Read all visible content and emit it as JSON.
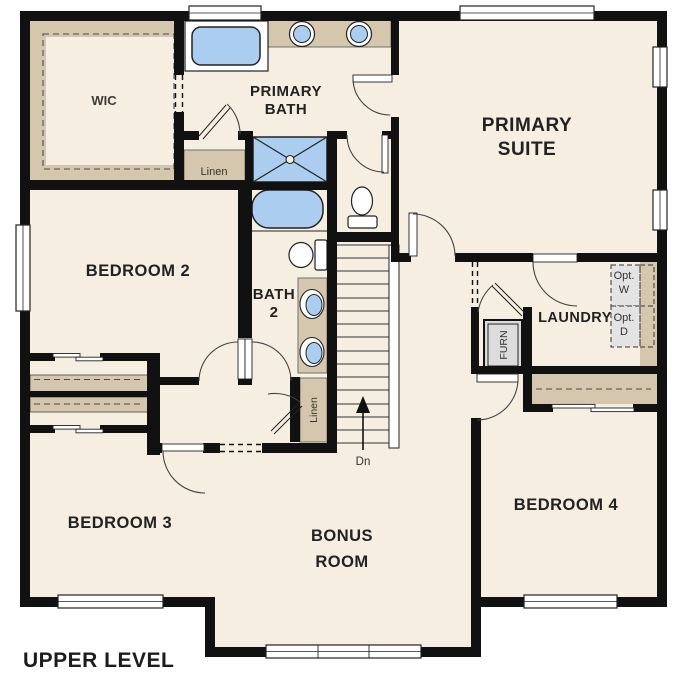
{
  "plan": {
    "title": "UPPER LEVEL"
  },
  "rooms": {
    "wic": {
      "label": "WIC"
    },
    "primary_bath": {
      "l1": "PRIMARY",
      "l2": "BATH"
    },
    "primary_suite": {
      "l1": "PRIMARY",
      "l2": "SUITE"
    },
    "bedroom2": {
      "label": "BEDROOM 2"
    },
    "bath2": {
      "l1": "BATH",
      "l2": "2"
    },
    "laundry": {
      "label": "LAUNDRY"
    },
    "bedroom3": {
      "label": "BEDROOM 3"
    },
    "bonus_room": {
      "l1": "BONUS",
      "l2": "ROOM"
    },
    "bedroom4": {
      "label": "BEDROOM 4"
    }
  },
  "closets": {
    "linen_upper": "Linen",
    "linen_hall": "Linen"
  },
  "equipment": {
    "furnace": "FURN",
    "opt_washer_l1": "Opt.",
    "opt_washer_l2": "W",
    "opt_dryer_l1": "Opt.",
    "opt_dryer_l2": "D"
  },
  "stairs": {
    "direction": "Dn"
  },
  "colors": {
    "floor": "#f5eee1",
    "wall": "#111111",
    "cabinet_tan": "#d5c7ae",
    "fixture_blue": "#aacdf0",
    "equipment_gray": "#e0e0e0",
    "background": "#ffffff"
  }
}
